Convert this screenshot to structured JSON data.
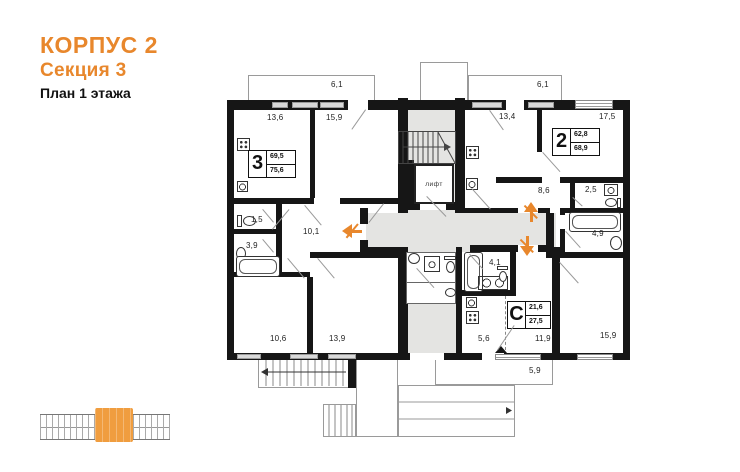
{
  "title": {
    "line1": "КОРПУС 2",
    "line2": "Секция 3",
    "line3": "План 1 этажа"
  },
  "colors": {
    "accent": "#E8872C",
    "wall": "#161616",
    "common_area": "#E4E4E2",
    "minimap_orange": "#F09D3F"
  },
  "elevator_label": "лифт",
  "apartments": {
    "apt3": {
      "num": "3",
      "area_living": "69,5",
      "area_total": "75,6"
    },
    "apt2": {
      "num": "2",
      "area_living": "62,8",
      "area_total": "68,9"
    },
    "studio": {
      "num": "С",
      "area_living": "21,6",
      "area_total": "27,5"
    }
  },
  "room_labels": [
    {
      "text": "6,1",
      "x": 331,
      "y": 80
    },
    {
      "text": "13,6",
      "x": 267,
      "y": 113
    },
    {
      "text": "15,9",
      "x": 326,
      "y": 113
    },
    {
      "text": "6,1",
      "x": 537,
      "y": 80
    },
    {
      "text": "13,4",
      "x": 499,
      "y": 112
    },
    {
      "text": "17,5",
      "x": 599,
      "y": 112
    },
    {
      "text": "8,6",
      "x": 538,
      "y": 186
    },
    {
      "text": "2,5",
      "x": 585,
      "y": 185
    },
    {
      "text": "4,9",
      "x": 592,
      "y": 229
    },
    {
      "text": "10,1",
      "x": 303,
      "y": 227
    },
    {
      "text": "1,5",
      "x": 251,
      "y": 215
    },
    {
      "text": "3,9",
      "x": 246,
      "y": 241
    },
    {
      "text": "10,6",
      "x": 270,
      "y": 334
    },
    {
      "text": "13,9",
      "x": 329,
      "y": 334
    },
    {
      "text": "4,1",
      "x": 489,
      "y": 258
    },
    {
      "text": "5,6",
      "x": 478,
      "y": 334
    },
    {
      "text": "11,9",
      "x": 535,
      "y": 334
    },
    {
      "text": "15,9",
      "x": 600,
      "y": 331
    },
    {
      "text": "5,9",
      "x": 529,
      "y": 366
    }
  ],
  "windows": [
    {
      "x": 272,
      "y": 102,
      "w": 16,
      "h": 6,
      "style": "bar"
    },
    {
      "x": 292,
      "y": 102,
      "w": 26,
      "h": 6,
      "style": "bar"
    },
    {
      "x": 320,
      "y": 102,
      "w": 24,
      "h": 6,
      "style": "bar"
    },
    {
      "x": 472,
      "y": 102,
      "w": 30,
      "h": 6,
      "style": "bar"
    },
    {
      "x": 528,
      "y": 102,
      "w": 26,
      "h": 6,
      "style": "bar"
    },
    {
      "x": 575,
      "y": 100,
      "w": 38,
      "h": 9,
      "style": "striped"
    },
    {
      "x": 237,
      "y": 354,
      "w": 24,
      "h": 5,
      "style": "bar"
    },
    {
      "x": 290,
      "y": 354,
      "w": 28,
      "h": 5,
      "style": "bar"
    },
    {
      "x": 328,
      "y": 354,
      "w": 28,
      "h": 5,
      "style": "bar"
    },
    {
      "x": 495,
      "y": 354,
      "w": 46,
      "h": 6,
      "style": "striped"
    },
    {
      "x": 577,
      "y": 354,
      "w": 36,
      "h": 6,
      "style": "striped"
    }
  ],
  "door_swings": [
    {
      "x": 272,
      "y": 229,
      "len": 26,
      "deg": -50
    },
    {
      "x": 305,
      "y": 205,
      "len": 26,
      "deg": 50
    },
    {
      "x": 366,
      "y": 110,
      "len": 24,
      "deg": 125
    },
    {
      "x": 490,
      "y": 110,
      "len": 24,
      "deg": 55
    },
    {
      "x": 384,
      "y": 204,
      "len": 24,
      "deg": 128
    },
    {
      "x": 288,
      "y": 258,
      "len": 26,
      "deg": 50
    },
    {
      "x": 318,
      "y": 258,
      "len": 26,
      "deg": 50
    },
    {
      "x": 263,
      "y": 209,
      "len": 17,
      "deg": 50
    },
    {
      "x": 263,
      "y": 239,
      "len": 17,
      "deg": 50
    },
    {
      "x": 427,
      "y": 196,
      "len": 28,
      "deg": 46
    },
    {
      "x": 472,
      "y": 188,
      "len": 28,
      "deg": 48
    },
    {
      "x": 543,
      "y": 152,
      "len": 26,
      "deg": 48
    },
    {
      "x": 573,
      "y": 197,
      "len": 13,
      "deg": 42
    },
    {
      "x": 566,
      "y": 231,
      "len": 22,
      "deg": 48
    },
    {
      "x": 560,
      "y": 262,
      "len": 28,
      "deg": 48
    },
    {
      "x": 417,
      "y": 268,
      "len": 26,
      "deg": 48
    },
    {
      "x": 470,
      "y": 254,
      "len": 20,
      "deg": 48
    },
    {
      "x": 497,
      "y": 350,
      "len": 30,
      "deg": -56
    }
  ],
  "entry_arrows": [
    {
      "x": 340,
      "y": 219,
      "dir": "left"
    },
    {
      "x": 519,
      "y": 200,
      "dir": "up"
    },
    {
      "x": 515,
      "y": 234,
      "dir": "down"
    }
  ]
}
